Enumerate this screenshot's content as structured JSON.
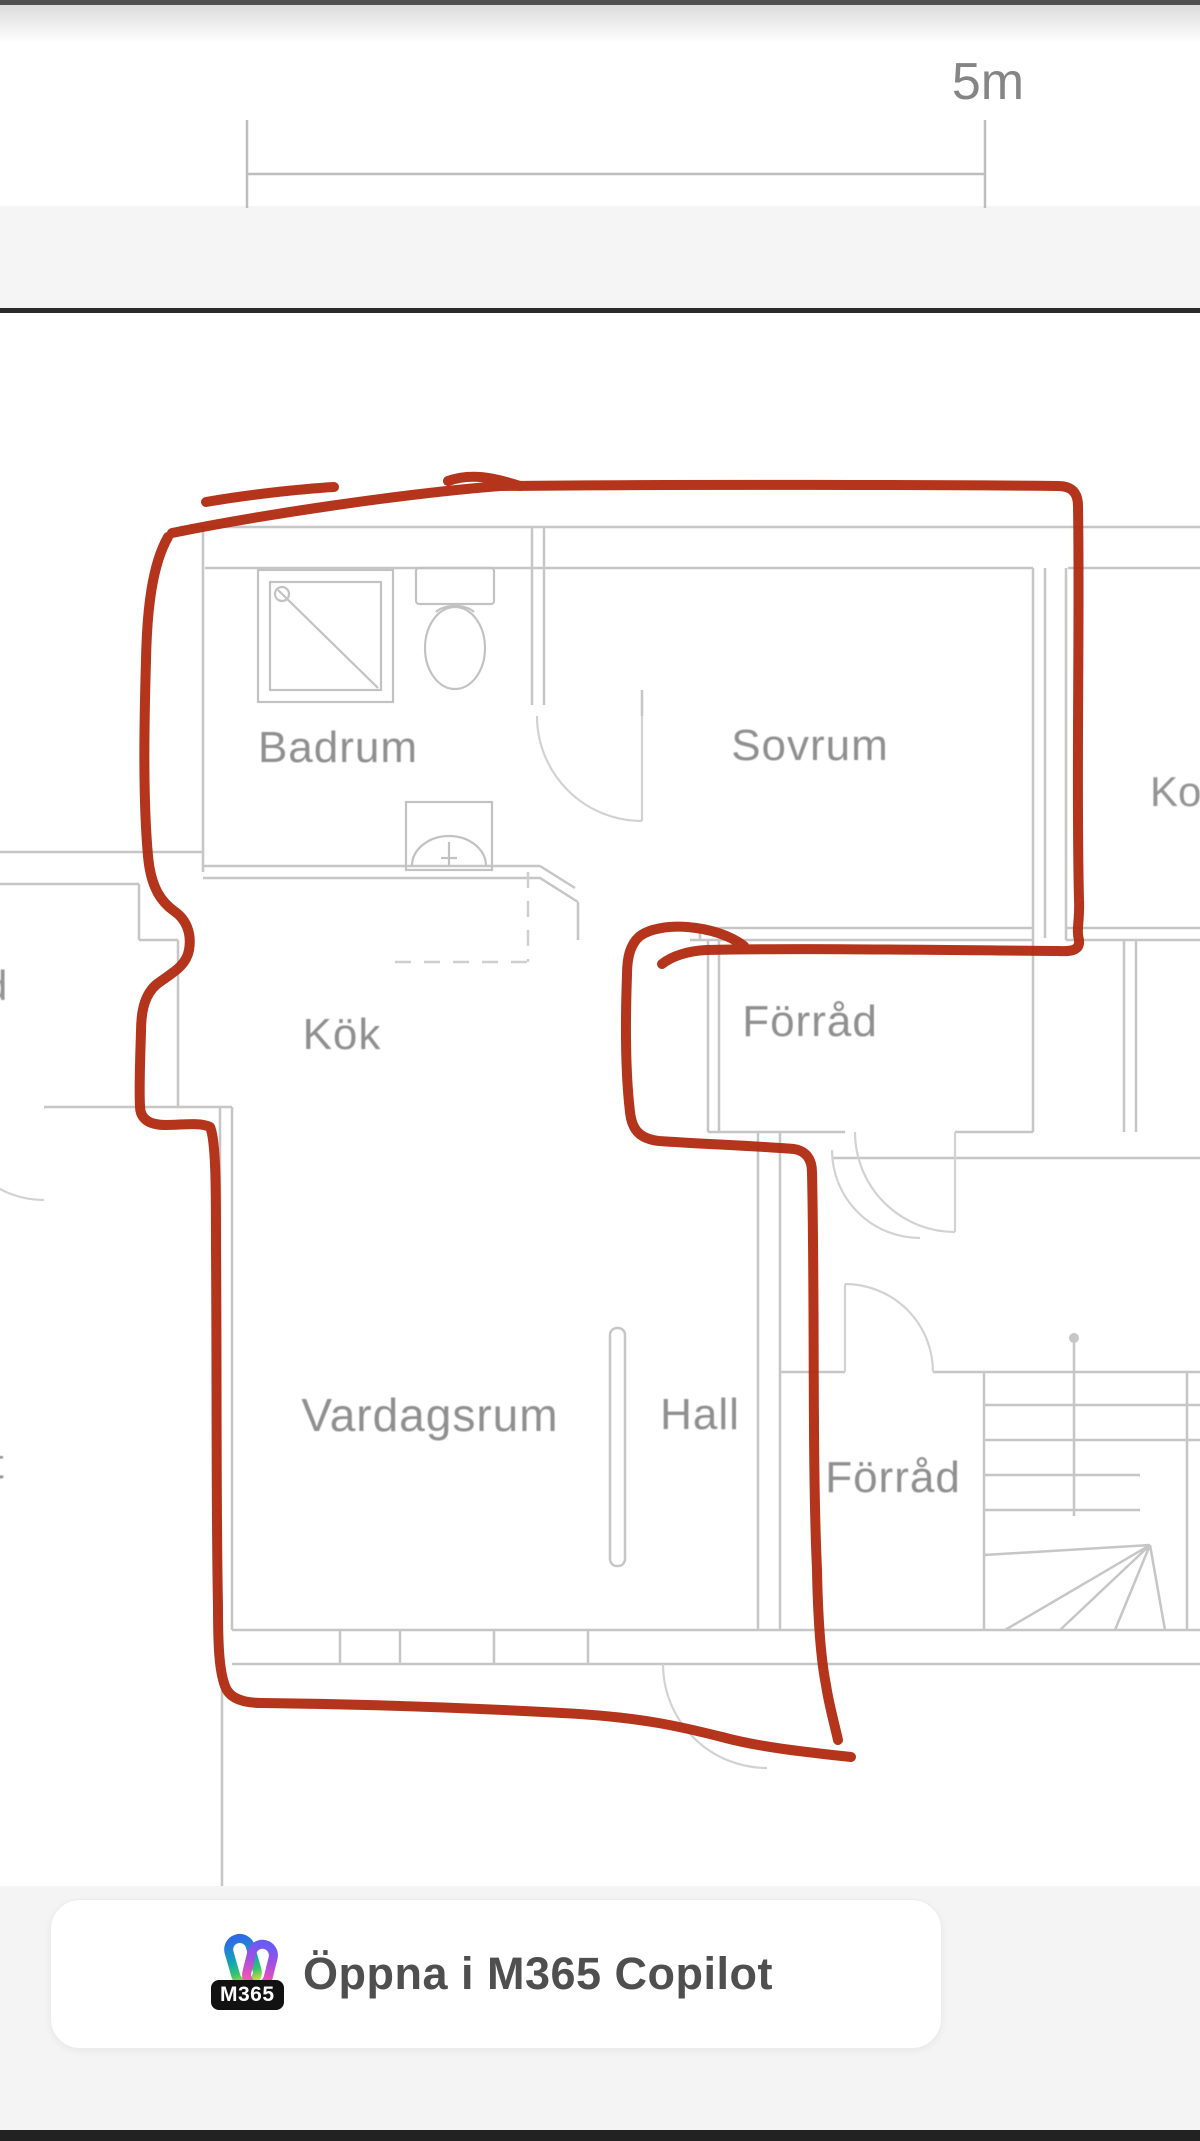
{
  "scale_bar": {
    "top_label": "5m",
    "bottom_label": "5m"
  },
  "floor_plan": {
    "rooms": {
      "badrum": {
        "label": "Badrum"
      },
      "sovrum": {
        "label": "Sovrum"
      },
      "kok": {
        "label": "Kök"
      },
      "forrad_upper": {
        "label": "Förråd"
      },
      "vardagsrum": {
        "label": "Vardagsrum"
      },
      "hall": {
        "label": "Hall"
      },
      "forrad_lower": {
        "label": "Förråd"
      }
    },
    "partial_labels": {
      "right": "Ko",
      "left_top": "d",
      "left_bottom": "t"
    },
    "annotation_color": "#b02a10",
    "wall_color": "#c6c6c6",
    "label_color": "#8f8f8f"
  },
  "copilot_button": {
    "label": "Öppna i M365 Copilot",
    "badge": "M365",
    "icon": "m365-copilot-logo"
  }
}
